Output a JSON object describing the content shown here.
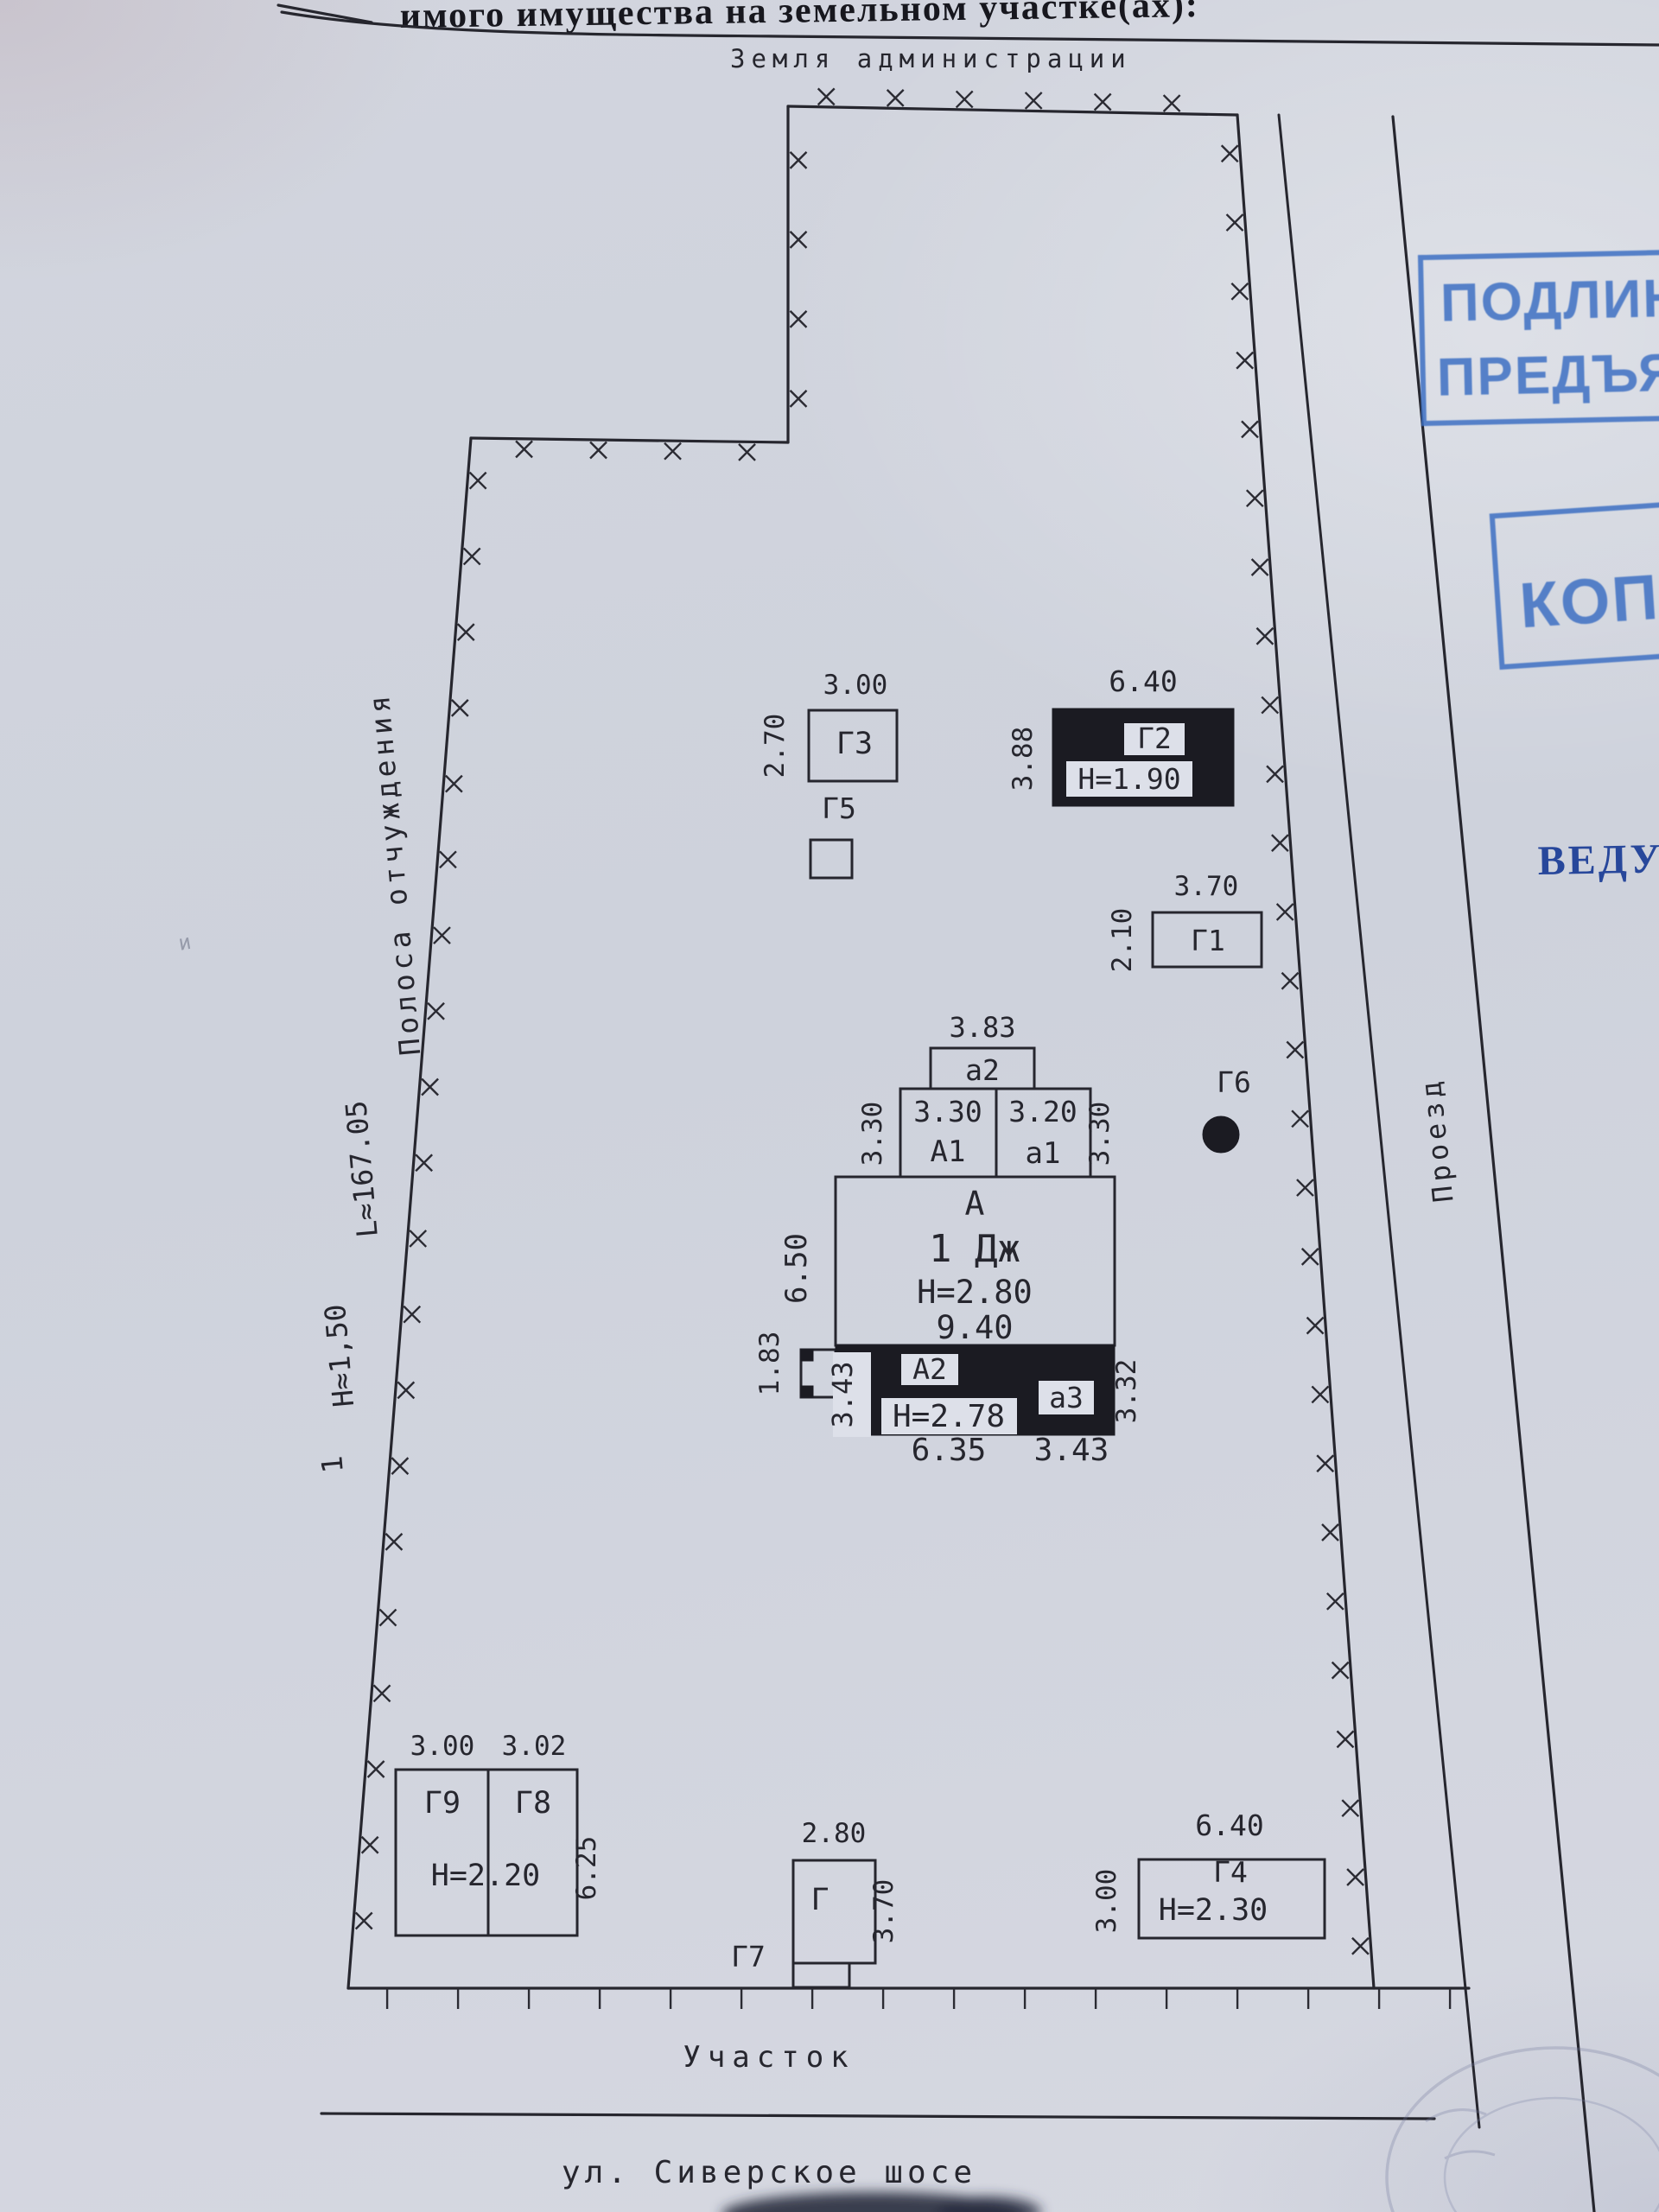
{
  "header": {
    "title": "имого имущества на земельном участке(ах):",
    "land_note": "Земля администрации"
  },
  "margins": {
    "point_mark": "1",
    "fence_height": "Н≈1,50",
    "fence_length": "L≈167.05",
    "strip_label": "Полоса отчуждения",
    "road_label": "Проезд",
    "plot_label": "Участок",
    "street_label": "ул. Сиверское шосе"
  },
  "stamps": {
    "authentic_line1": "ПОДЛИН",
    "authentic_line2": "ПРЕДЪЯ",
    "copy": "КОПИЯ",
    "lead": "ВЕДУЩ"
  },
  "buildings": {
    "g3": {
      "label": "Г3",
      "width": "3.00",
      "depth": "2.70"
    },
    "g5": {
      "label": "Г5"
    },
    "g2": {
      "label": "Г2",
      "width": "6.40",
      "depth": "3.88",
      "height_note": "Н=1.90"
    },
    "g1": {
      "label": "Г1",
      "width": "3.70",
      "depth": "2.10"
    },
    "g6": {
      "label": "Г6"
    },
    "g9": {
      "label": "Г9",
      "width": "3.00"
    },
    "g8": {
      "label": "Г8",
      "width": "3.02"
    },
    "g9_g8_height_note": "Н=2.20",
    "g9_g8_depth": "6.25",
    "g7": {
      "label": "Г7"
    },
    "g": {
      "label": "Г",
      "width": "2.80",
      "depth": "3.70"
    },
    "g4": {
      "label": "Г4",
      "width": "6.40",
      "depth": "3.00",
      "height_note": "Н=2.30"
    }
  },
  "main_building": {
    "a2_porch": {
      "label": "а2",
      "width": "3.83"
    },
    "a1_big": {
      "label": "А1",
      "width": "3.30",
      "depth_left": "3.30"
    },
    "a1_small": {
      "label": "а1",
      "width": "3.20",
      "depth_right": "3.30"
    },
    "block": {
      "label": "А",
      "unit": "1 Дж",
      "height_note": "Н=2.80",
      "width": "9.40",
      "depth": "6.50"
    },
    "a2_ext": {
      "label": "А2",
      "height_note": "Н=2.78",
      "depth": "3.43",
      "width": "6.35"
    },
    "a3_ext": {
      "label": "а3",
      "width": "3.43",
      "depth": "3.32"
    },
    "porch": {
      "depth": "1.83"
    }
  },
  "artifacts": {
    "pencil_mark": "и"
  }
}
